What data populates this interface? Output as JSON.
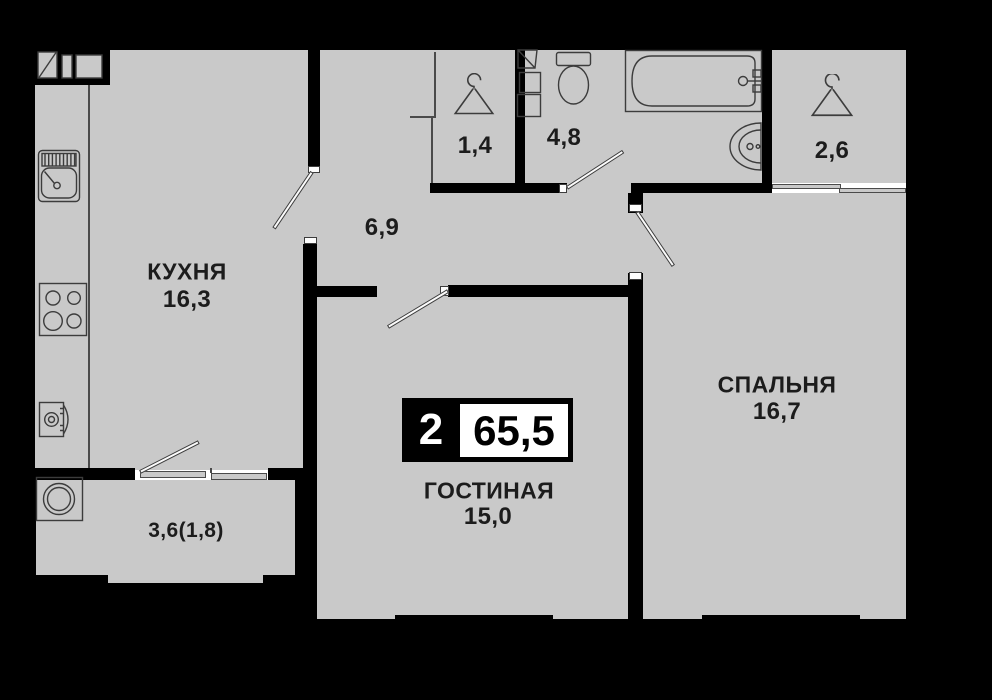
{
  "plan": {
    "type": "apartment-floor-plan",
    "badge": {
      "room_count": "2",
      "total_area": "65,5"
    },
    "rooms": {
      "kitchen": {
        "name": "КУХНЯ",
        "area": "16,3"
      },
      "living": {
        "name": "ГОСТИНАЯ",
        "area": "15,0"
      },
      "bedroom": {
        "name": "СПАЛЬНЯ",
        "area": "16,7"
      },
      "hallway": {
        "area": "6,9"
      },
      "closet": {
        "area": "1,4"
      },
      "bathroom": {
        "area": "4,8"
      },
      "wardrobe": {
        "area": "2,6"
      },
      "balcony": {
        "area": "3,6(1,8)"
      }
    },
    "icons": [
      "hanger-icon",
      "kitchen-sink-icon",
      "stove-icon",
      "oven-icon",
      "washing-machine-icon",
      "toilet-icon",
      "bathtub-icon",
      "washbasin-icon",
      "bathroom-cabinet-icon",
      "vent-duct-icon"
    ],
    "colors": {
      "wall": "#000000",
      "floor": "#c9c9c9",
      "line": "#3c3c3c",
      "text": "#1c1c1c",
      "badge_bg": "#000000",
      "badge_panel": "#ffffff"
    }
  }
}
